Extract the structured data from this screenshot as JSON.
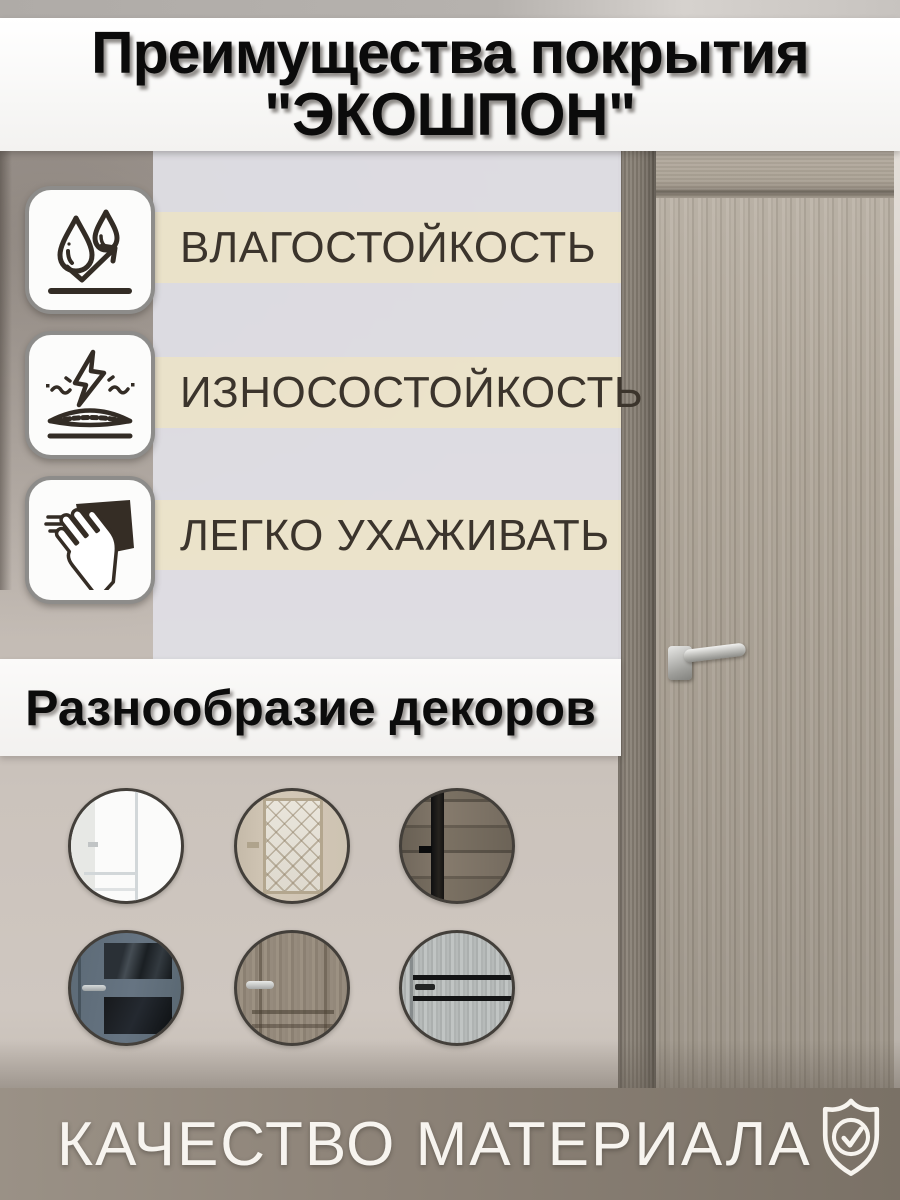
{
  "title": {
    "line1": "Преимущества покрытия",
    "line2": "\"ЭКОШПОН\""
  },
  "features": [
    {
      "id": "moisture",
      "label": "ВЛАГОСТОЙКОСТЬ",
      "icon": "water-drops-icon"
    },
    {
      "id": "wear",
      "label": "ИЗНОСОСТОЙКОСТЬ",
      "icon": "impact-resistance-icon"
    },
    {
      "id": "care",
      "label": "ЛЕГКО УХАЖИВАТЬ",
      "icon": "wiping-hand-icon"
    }
  ],
  "decors": {
    "heading": "Разнообразие декоров",
    "items": [
      {
        "name": "white-classic-door"
      },
      {
        "name": "beige-glass-lattice-door"
      },
      {
        "name": "dark-rustic-wood-door"
      },
      {
        "name": "blue-gray-glass-door"
      },
      {
        "name": "taupe-wood-panel-door"
      },
      {
        "name": "gray-wood-black-slit-door"
      }
    ]
  },
  "footer": {
    "label": "КАЧЕСТВО МАТЕРИАЛА",
    "icon": "shield-check-icon"
  },
  "colors": {
    "band_cream": "#ece4cb",
    "band_gray": "#dfdee3",
    "footer_taupe": "#8d8378",
    "icon_stroke": "#332c25"
  }
}
